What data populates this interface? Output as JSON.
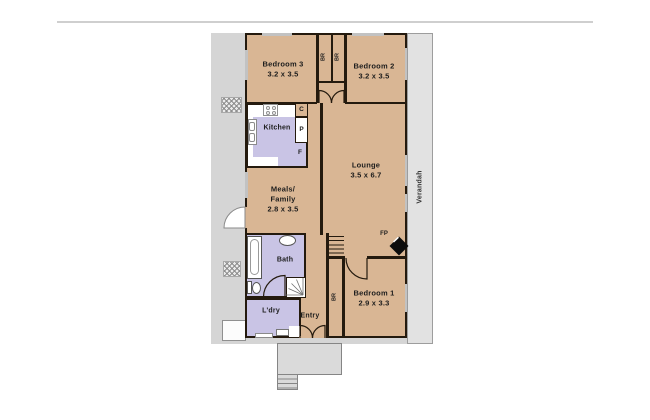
{
  "plan": {
    "type": "residential-floorplan",
    "rooms": {
      "bedroom3": {
        "name": "Bedroom 3",
        "dims": "3.2 x 3.5"
      },
      "bedroom2": {
        "name": "Bedroom 2",
        "dims": "3.2 x 3.5"
      },
      "bedroom1": {
        "name": "Bedroom 1",
        "dims": "2.9 x 3.3"
      },
      "lounge": {
        "name": "Lounge",
        "dims": "3.5 x 6.7"
      },
      "meals": {
        "name_line1": "Meals/",
        "name_line2": "Family",
        "dims": "2.8 x 3.5"
      },
      "kitchen": {
        "name": "Kitchen"
      },
      "bath": {
        "name": "Bath"
      },
      "laundry": {
        "name": "L'dry"
      },
      "entry": {
        "name": "Entry"
      },
      "verandah": {
        "name": "Verandah"
      }
    },
    "fixtures": {
      "robe_top_left": "BR",
      "robe_top_right": "BR",
      "robe_hall": "BR",
      "cupboard": "C",
      "pantry": "P",
      "fridge": "F",
      "fireplace": "FP"
    },
    "colors": {
      "room_tan": "#d9b694",
      "wet_area_purple": "#c9c4e5",
      "wall": "#241a0e",
      "land_grey": "#d5d5d5",
      "verandah_grey": "#e2e2e2",
      "porch_grey": "#dadada",
      "window_grey": "#c2c2c2"
    }
  }
}
